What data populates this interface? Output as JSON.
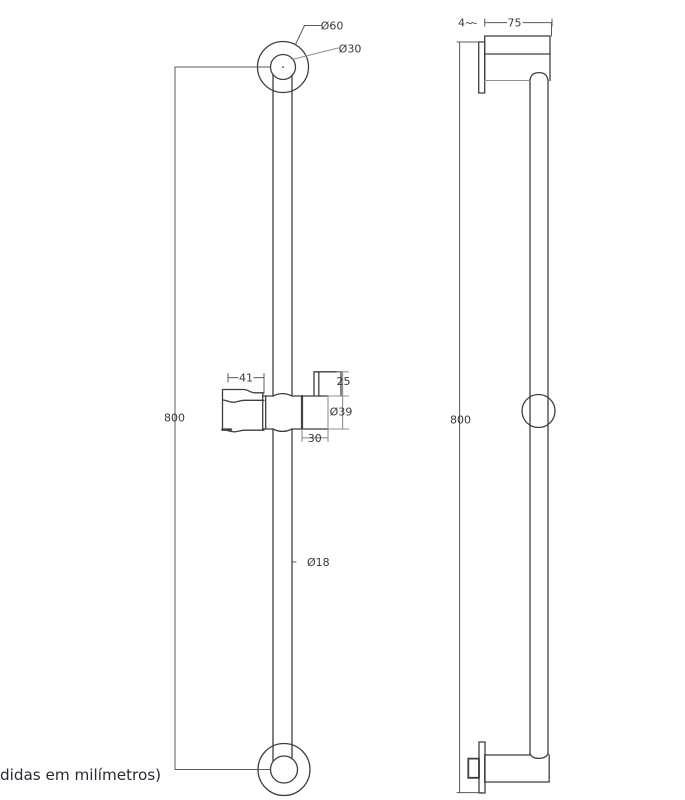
{
  "colors": {
    "background": "#ffffff",
    "object_line": "#3f3f3f",
    "secondary_line": "#8f8f8f",
    "dim_line": "#5a5a5a",
    "dim_gray_line": "#8c8c8c",
    "dim_text": "#3a3a3a",
    "note_text": "#2b2b36"
  },
  "drawing": {
    "type": "technical-drawing",
    "subject": "shower slide bar, two orthographic views",
    "units_note": "didas em milímetros)"
  },
  "front_view": {
    "label": "front view",
    "dims": {
      "flange_outer_diameter": "Ø60",
      "flange_inner_diameter": "Ø30",
      "overall_height": "800",
      "holder_length": "41",
      "knob_height": "25",
      "slider_diameter": "Ø39",
      "slider_width": "30",
      "bar_diameter": "Ø18"
    }
  },
  "side_view": {
    "label": "side view",
    "dims": {
      "overall_height": "800",
      "wall_plate_thickness": "4",
      "flange_depth": "75"
    }
  },
  "footer": {
    "note": "didas em milímetros)"
  }
}
